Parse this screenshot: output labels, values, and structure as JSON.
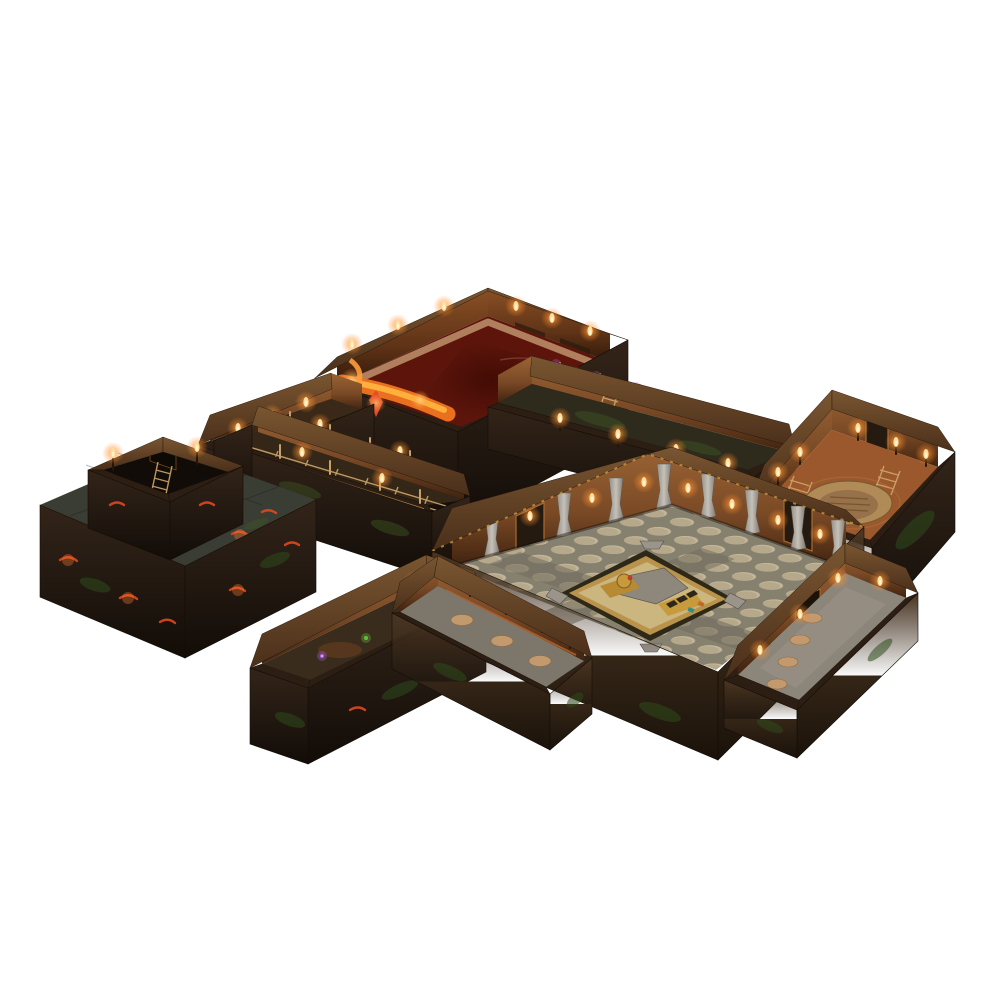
{
  "scene": {
    "type": "product-photo",
    "subject": "Modular tabletop dungeon terrain set photographed in isometric three-quarter view on a seamless white background",
    "style": "printed cardboard dungeon rooms and corridors joined into one sprawling lair",
    "background_color": "#ffffff",
    "modules": [
      {
        "id": "lava-chamber",
        "label": "Lava chamber",
        "features": [
          "blood-red pool floor",
          "molten lava flow in the west corner",
          "torch-lit timber walls",
          "pale stone ledge along the back walls",
          "red crystal on the outer wall"
        ]
      },
      {
        "id": "pit-corridor",
        "label": "Mine corridor to the pit platform",
        "features": [
          "torch sconces",
          "timber supports",
          "stacked crates"
        ]
      },
      {
        "id": "track-corridor",
        "label": "Mine corridor with cart track",
        "features": [
          "wooden fence rail",
          "floor rails",
          "torches"
        ]
      },
      {
        "id": "garden-corridor",
        "label": "Fenced corridor with glowing blossoms",
        "features": [
          "wooden rails",
          "purple flowers",
          "wall ladder",
          "torch sconces"
        ]
      },
      {
        "id": "round-hatch-room",
        "label": "Warm chamber with round stone hatch",
        "features": [
          "large circular floor hatch",
          "candle sconces",
          "gold pillar facade on the outer wall"
        ]
      },
      {
        "id": "pit-platform",
        "label": "Raised platform with pit entrance",
        "features": [
          "open pit shaft with ladder",
          "two corner torches",
          "lava-cracked dark stone",
          "green moss"
        ]
      },
      {
        "id": "great-hall",
        "label": "Great hall",
        "features": [
          "grey flagstone floor with pale round tiles",
          "gold diamond emblem inlay with chevrons",
          "white stone pillars",
          "bronze door frames",
          "torches"
        ]
      },
      {
        "id": "east-corridor",
        "label": "South-east corridor",
        "features": [
          "stone floor with tan medallions",
          "dark shrine panel",
          "candle light"
        ]
      },
      {
        "id": "fungus-corridor",
        "label": "Fungus corridor",
        "features": [
          "glowing purple and green fungi",
          "torch-lit corner junction"
        ]
      },
      {
        "id": "forge-corridor",
        "label": "Ornate dwarven corridor",
        "features": [
          "copper-banded wall",
          "candle sconces",
          "medallion floor"
        ]
      }
    ]
  },
  "palette": {
    "background": "#ffffff",
    "exterior_dark": "#241a12",
    "exterior_brown": "#3a2a1c",
    "moss_green": "#3f5622",
    "lava_floor": "#5d150b",
    "lava_pool": "#420c05",
    "magma": "#e8701f",
    "magma_bright": "#ffc35e",
    "wall_warm": "#8a5530",
    "wall_warm_dark": "#4a2a16",
    "timber": "#c99a5e",
    "hall_grout": "#86806f",
    "hall_tile": "#c8bb9d",
    "walkway": "#6f695c",
    "emblem_gold": "#b9934c",
    "emblem_field": "#ccb67f",
    "pillar_stone": "#bcb6ad",
    "tavern_floor": "#9a582c",
    "hatch_stone": "#b08a57",
    "medallion_tan": "#c29a6e",
    "fungus_purple": "#a85ce0",
    "fungus_green": "#5fc23c",
    "flame_core": "#ffdf9f",
    "flame_glow": "#ffa43c",
    "gold_trim": "#c9a845",
    "crystal_red": "#e5482a"
  }
}
